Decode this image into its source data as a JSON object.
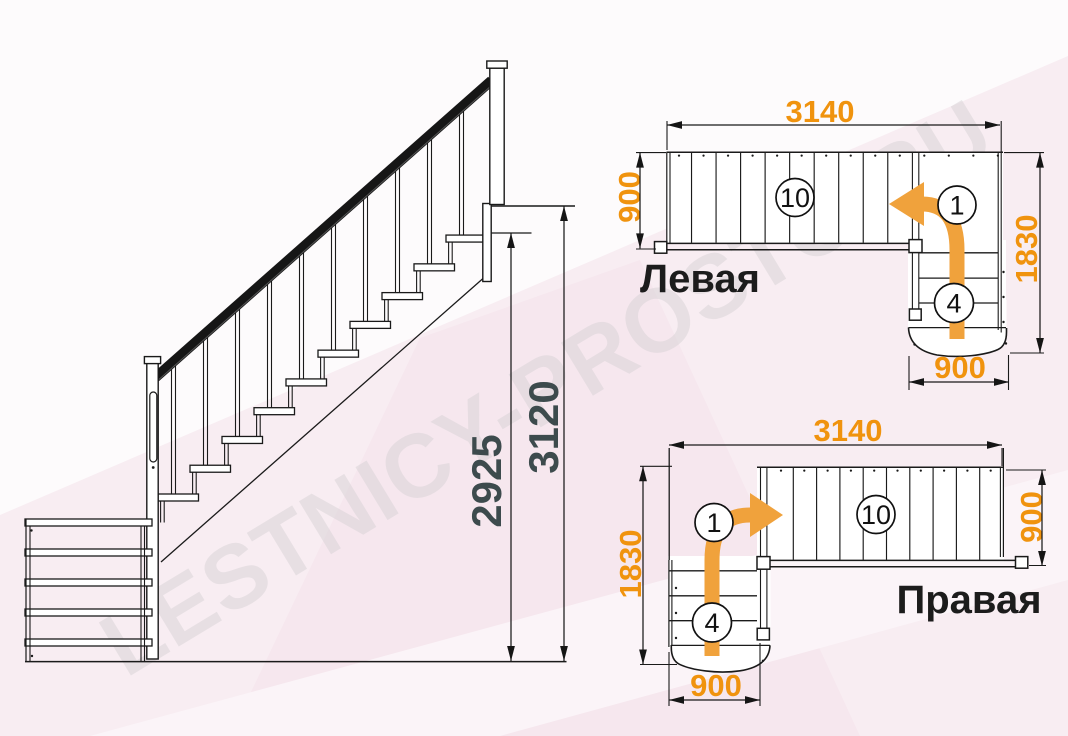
{
  "watermark": {
    "text": "LESTNICY-PROSTO.RU"
  },
  "side_view": {
    "dim_height_steps": "2925",
    "dim_height_total": "3120"
  },
  "plan_left": {
    "label": "Левая",
    "dim_length": "3140",
    "dim_flight_width": "900",
    "dim_turn_length": "1830",
    "dim_lower_width": "900",
    "step_first": "1",
    "steps_straight": "10",
    "steps_winder": "4"
  },
  "plan_right": {
    "label": "Правая",
    "dim_length": "3140",
    "dim_flight_width": "900",
    "dim_turn_length": "1830",
    "dim_lower_width": "900",
    "step_first": "1",
    "steps_straight": "10",
    "steps_winder": "4"
  },
  "colors": {
    "dimension_orange": "#F0930E",
    "arrow_orange": "#F0A23C",
    "dim_dark_text": "#3D4B4D",
    "line": "#1A1A1A",
    "background_pink": "#F8EDF2"
  }
}
